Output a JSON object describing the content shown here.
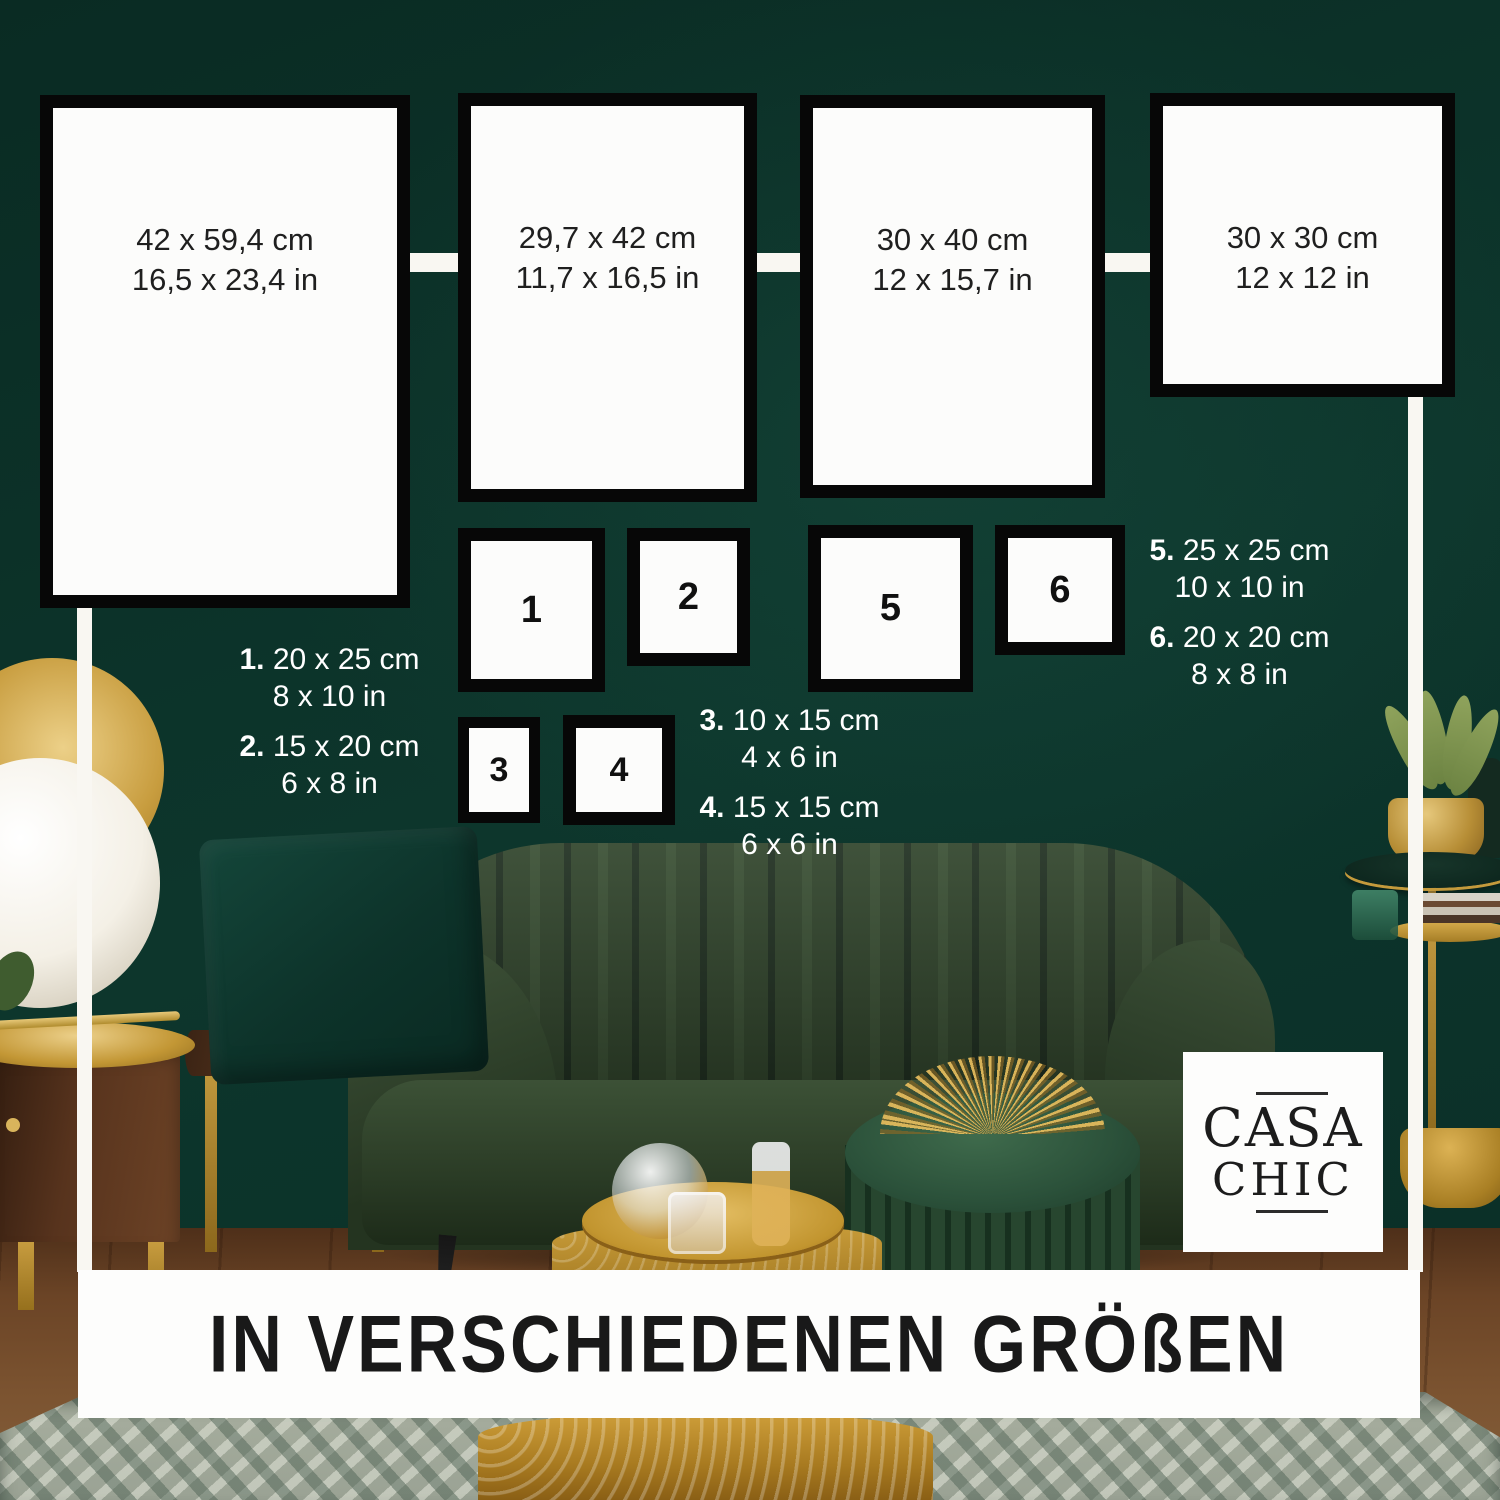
{
  "banner": {
    "title": "IN VERSCHIEDENEN GRÖßEN"
  },
  "brand": {
    "name": "Casa Chic",
    "line1": "CASA",
    "line2": "CHIC"
  },
  "colors": {
    "wall_green": "#0c352c",
    "frame_border": "#070707",
    "frame_face": "#fcfcfb",
    "connector_white": "#f9f7f2",
    "accent_gold": "#c49a3c",
    "text_dark": "#1f1f1f",
    "text_light": "#ffffff"
  },
  "large_frames": [
    {
      "cm": "42 x 59,4 cm",
      "inch": "16,5 x 23,4 in"
    },
    {
      "cm": "29,7 x 42 cm",
      "inch": "11,7 x 16,5 in"
    },
    {
      "cm": "30 x 40 cm",
      "inch": "12 x 15,7 in"
    },
    {
      "cm": "30 x 30 cm",
      "inch": "12 x 12 in"
    }
  ],
  "numbered_frames": [
    {
      "number": "1"
    },
    {
      "number": "2"
    },
    {
      "number": "3"
    },
    {
      "number": "4"
    },
    {
      "number": "5"
    },
    {
      "number": "6"
    }
  ],
  "legend": [
    {
      "number": "1.",
      "cm": "20 x 25 cm",
      "inch": "8 x 10 in"
    },
    {
      "number": "2.",
      "cm": "15 x 20 cm",
      "inch": "6 x 8 in"
    },
    {
      "number": "3.",
      "cm": "10 x 15 cm",
      "inch": "4 x 6 in"
    },
    {
      "number": "4.",
      "cm": "15 x 15 cm",
      "inch": "6 x 6 in"
    },
    {
      "number": "5.",
      "cm": "25 x 25 cm",
      "inch": "10 x 10 in"
    },
    {
      "number": "6.",
      "cm": "20 x 20 cm",
      "inch": "8 x 8 in"
    }
  ]
}
